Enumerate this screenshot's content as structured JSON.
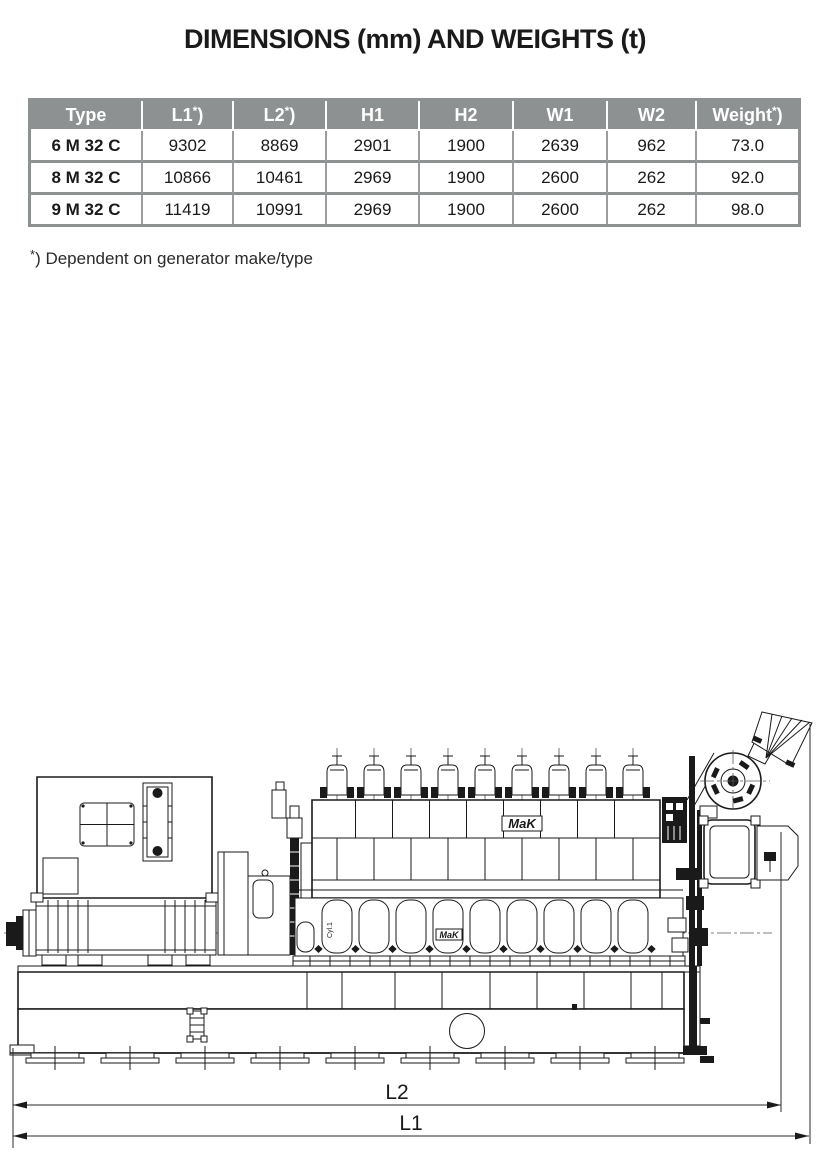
{
  "page": {
    "title": "DIMENSIONS (mm) AND WEIGHTS (t)"
  },
  "colors": {
    "table_header_bg": "#8E9192",
    "table_grid": "#9B9EA0",
    "text": "#1A1A1A",
    "drawing_line": "#1A1A1A"
  },
  "table": {
    "headers": [
      {
        "label": "Type",
        "sup": "",
        "close": ""
      },
      {
        "label": "L1",
        "sup": "*",
        "close": ")"
      },
      {
        "label": "L2",
        "sup": "*",
        "close": ")"
      },
      {
        "label": "H1",
        "sup": "",
        "close": ""
      },
      {
        "label": "H2",
        "sup": "",
        "close": ""
      },
      {
        "label": "W1",
        "sup": "",
        "close": ""
      },
      {
        "label": "W2",
        "sup": "",
        "close": ""
      },
      {
        "label": "Weight",
        "sup": "*",
        "close": ")"
      }
    ],
    "rows": [
      {
        "type": "6 M 32 C",
        "values": [
          "9302",
          "8869",
          "2901",
          "1900",
          "2639",
          "962",
          "73.0"
        ]
      },
      {
        "type": "8 M 32 C",
        "values": [
          "10866",
          "10461",
          "2969",
          "1900",
          "2600",
          "262",
          "92.0"
        ]
      },
      {
        "type": "9 M 32 C",
        "values": [
          "11419",
          "10991",
          "2969",
          "1900",
          "2600",
          "262",
          "98.0"
        ]
      }
    ]
  },
  "footnote": {
    "sup": "*",
    "text": ") Dependent on generator make/type"
  },
  "drawing": {
    "labels": {
      "dim_l2": "L2",
      "dim_l1": "L1",
      "brand_large": "MaK",
      "brand_small": "MaK",
      "cyl1": "Cyl.1"
    }
  }
}
